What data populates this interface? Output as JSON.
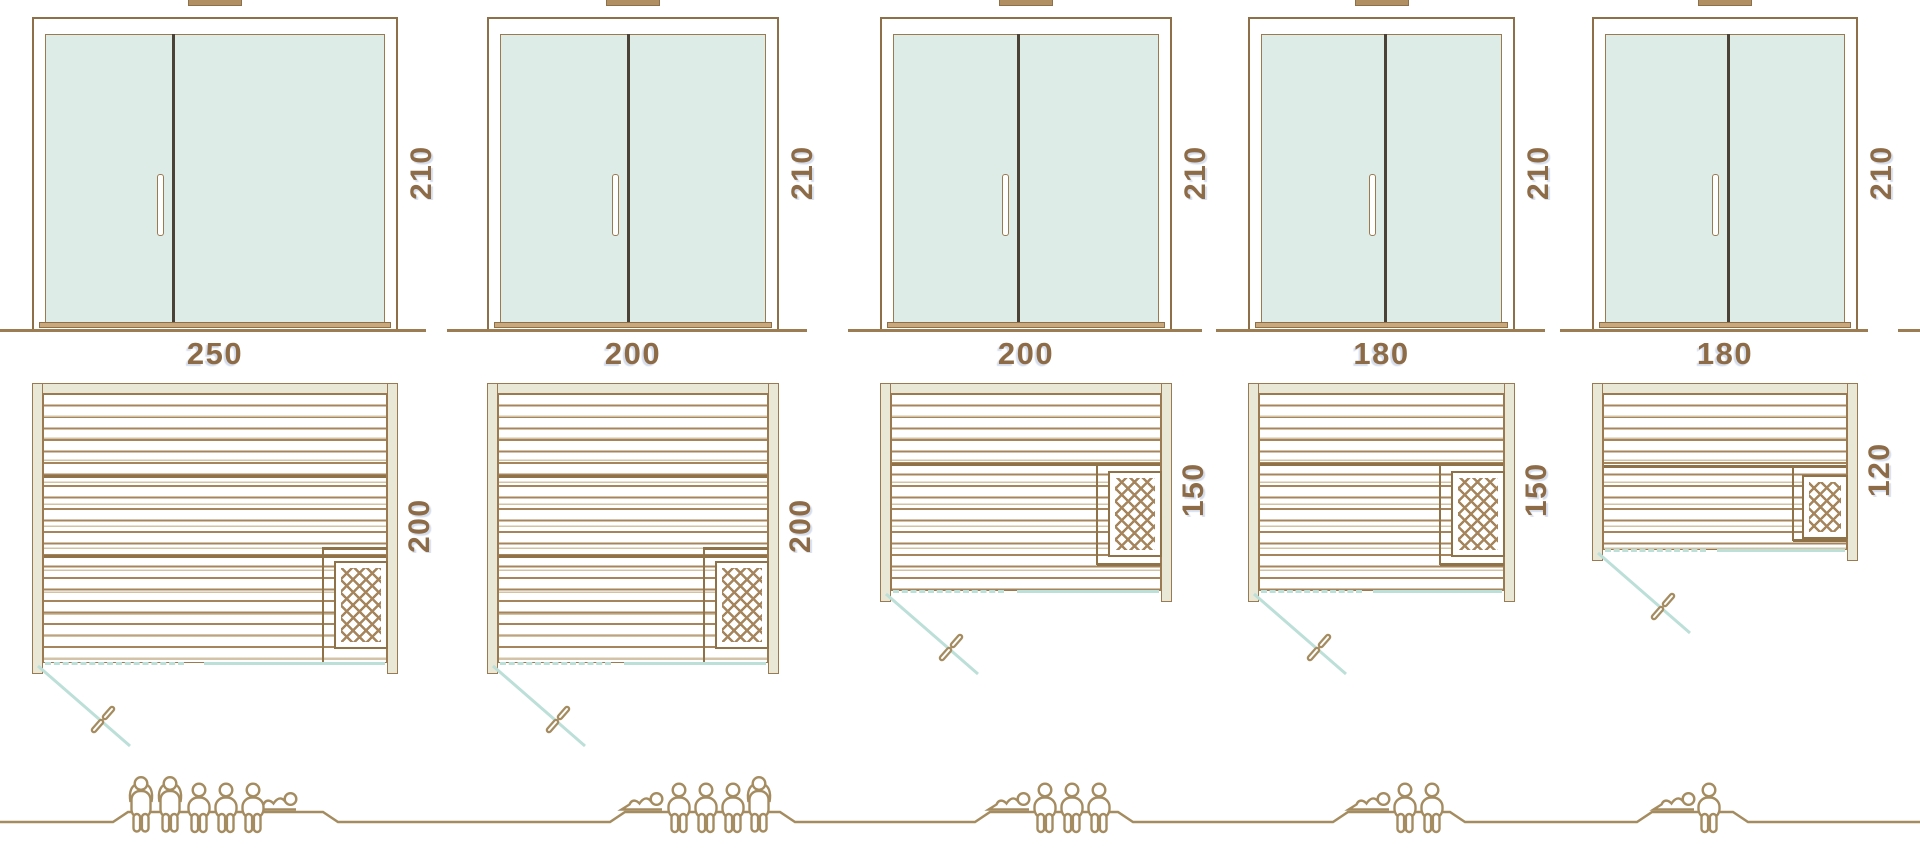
{
  "units": [
    {
      "door_height": "210",
      "width": "250",
      "depth": "200",
      "capacity": {
        "standing": 2,
        "seated": 3,
        "lying": 1,
        "total": 6
      }
    },
    {
      "door_height": "210",
      "width": "200",
      "depth": "200",
      "capacity": {
        "standing": 1,
        "seated": 3,
        "lying": 1,
        "total": 5
      }
    },
    {
      "door_height": "210",
      "width": "200",
      "depth": "150",
      "capacity": {
        "standing": 0,
        "seated": 3,
        "lying": 1,
        "total": 4
      }
    },
    {
      "door_height": "210",
      "width": "180",
      "depth": "150",
      "capacity": {
        "standing": 0,
        "seated": 2,
        "lying": 1,
        "total": 3
      }
    },
    {
      "door_height": "210",
      "width": "180",
      "depth": "120",
      "capacity": {
        "standing": 0,
        "seated": 1,
        "lying": 1,
        "total": 2
      }
    }
  ],
  "colors": {
    "frame_brown": "#8d7049",
    "line_soft": "#9b7a52",
    "glass_mint": "#ddece7",
    "wall_beige": "#e9e7d6",
    "plank_brown": "#a6855d",
    "plank_light": "#d3c3a3",
    "teal": "#bcdfd8",
    "figure_tan": "#a58c60",
    "dim_text": "#8d6b46",
    "threshold_tan": "#c9a97c",
    "divider_dark": "#4a4237",
    "vent_tan": "#b08f63",
    "ground_brown": "#9c7c52",
    "bench_brown": "#8f7248"
  }
}
